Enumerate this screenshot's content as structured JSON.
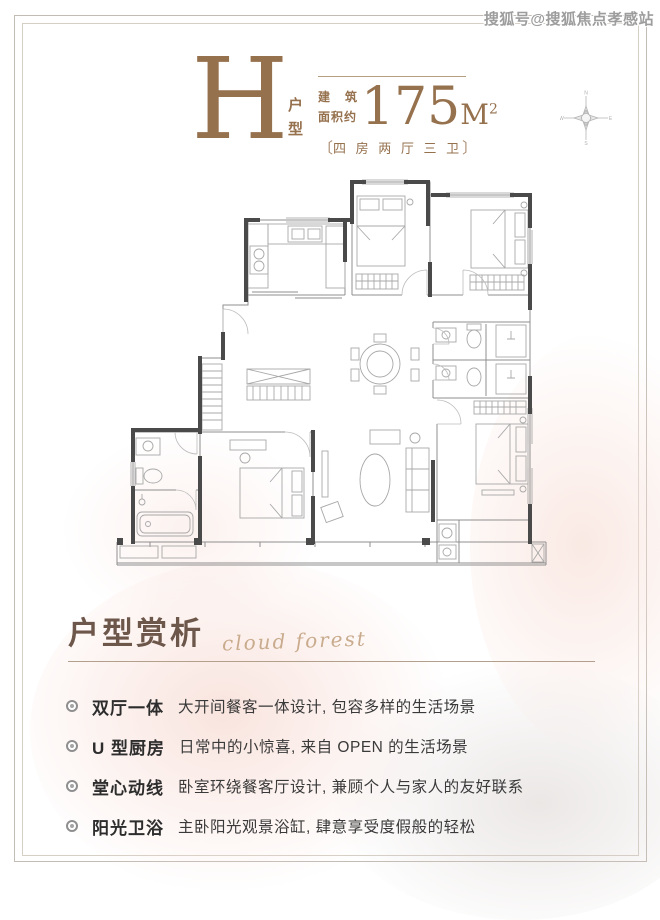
{
  "watermark": "搜狐号@搜狐焦点孝感站",
  "header": {
    "type_letter": "H",
    "type_label": "户型",
    "area_prefix_char1": "建",
    "area_prefix_char2": "筑",
    "area_prefix_line2": "面积约",
    "area_value": "175",
    "area_unit": "M",
    "area_sup": "2",
    "bracket_left": "〔",
    "bracket_right": "〕",
    "layout_spec": "四 房 两 厅 三 卫"
  },
  "compass": {
    "north": "N",
    "south": "S",
    "east": "E",
    "west": "W"
  },
  "section": {
    "title": "户型赏析",
    "subtitle_script": "cloud forest"
  },
  "features": [
    {
      "label": "双厅一体",
      "desc": "大开间餐客一体设计, 包容多样的生活场景"
    },
    {
      "label": "U 型厨房",
      "desc": "日常中的小惊喜, 来自 OPEN 的生活场景"
    },
    {
      "label": "堂心动线",
      "desc": "卧室环绕餐客厅设计, 兼顾个人与家人的友好联系"
    },
    {
      "label": "阳光卫浴",
      "desc": "主卧阳光观景浴缸, 肆意享受度假般的轻松"
    }
  ],
  "colors": {
    "accent_brown": "#96714e",
    "heading_brown": "#6d564a",
    "wall_dark": "#4a4a4a",
    "watermark_gray": "#9d9d9d",
    "rose_tint": "#f7dbd3"
  }
}
